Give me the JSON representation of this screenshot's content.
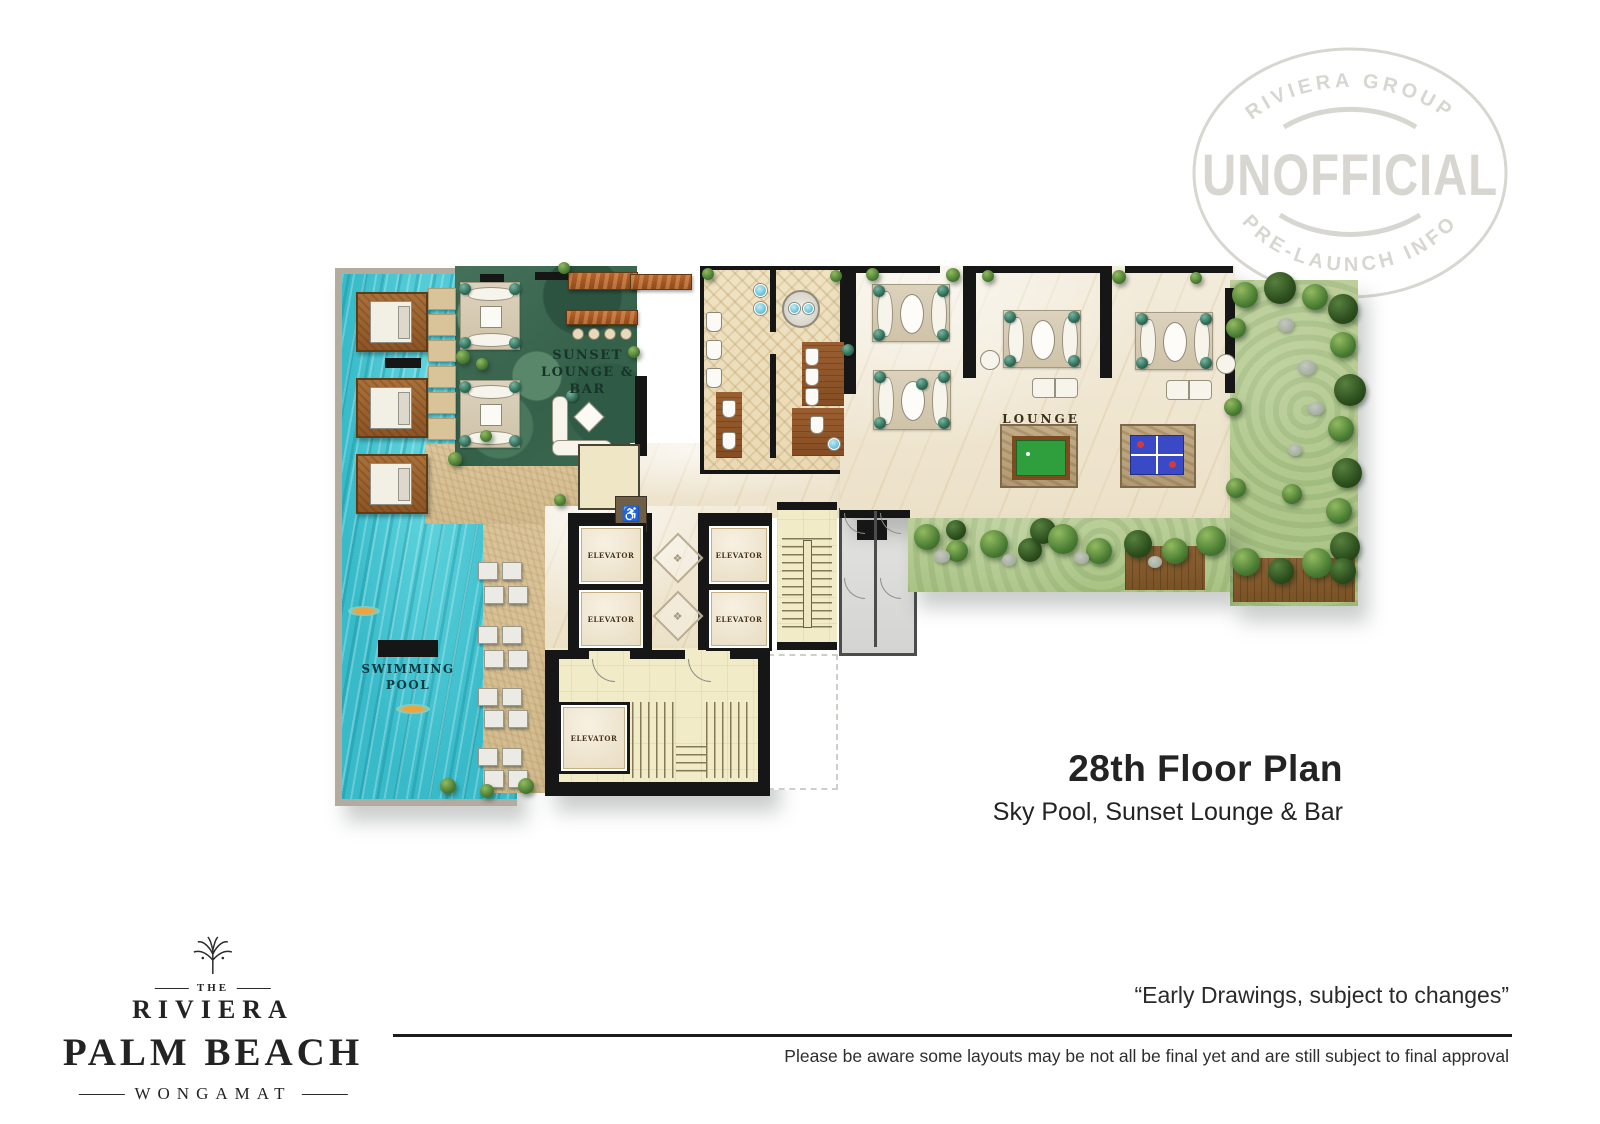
{
  "watermark": {
    "arc_top": "RIVIERA GROUP",
    "center": "UNOFFICIAL",
    "arc_bottom": "PRE-LAUNCH INFO",
    "color": "#d7d6d1"
  },
  "plan": {
    "labels": {
      "sunset_line1": "SUNSET",
      "sunset_line2": "LOUNGE & BAR",
      "pool_line1": "SWIMMING",
      "pool_line2": "POOL",
      "lounge": "LOUNGE",
      "elevator": "ELEVATOR"
    },
    "icons": {
      "accessible": "♿",
      "medallion": "❖"
    },
    "colors": {
      "pool_water": "#41c4d0",
      "deck": "#d8c197",
      "lounge_green": "#3f6a52",
      "marble": "#f0e8d6",
      "garden": "#b6cd95",
      "wall": "#161616",
      "wood": "#9a5c2e",
      "billiards_table": "#2f9e3d",
      "pingpong_table": "#3a49c6"
    }
  },
  "caption": {
    "title": "28th Floor Plan",
    "subtitle": "Sky Pool, Sunset Lounge & Bar"
  },
  "logo": {
    "the": "THE",
    "name": "RIVIERA",
    "line2": "PALM BEACH",
    "line3": "WONGAMAT"
  },
  "footer": {
    "quote": "“Early Drawings, subject to changes”",
    "disclaimer": "Please be aware some layouts may be not all be final yet and are still subject to final approval"
  }
}
